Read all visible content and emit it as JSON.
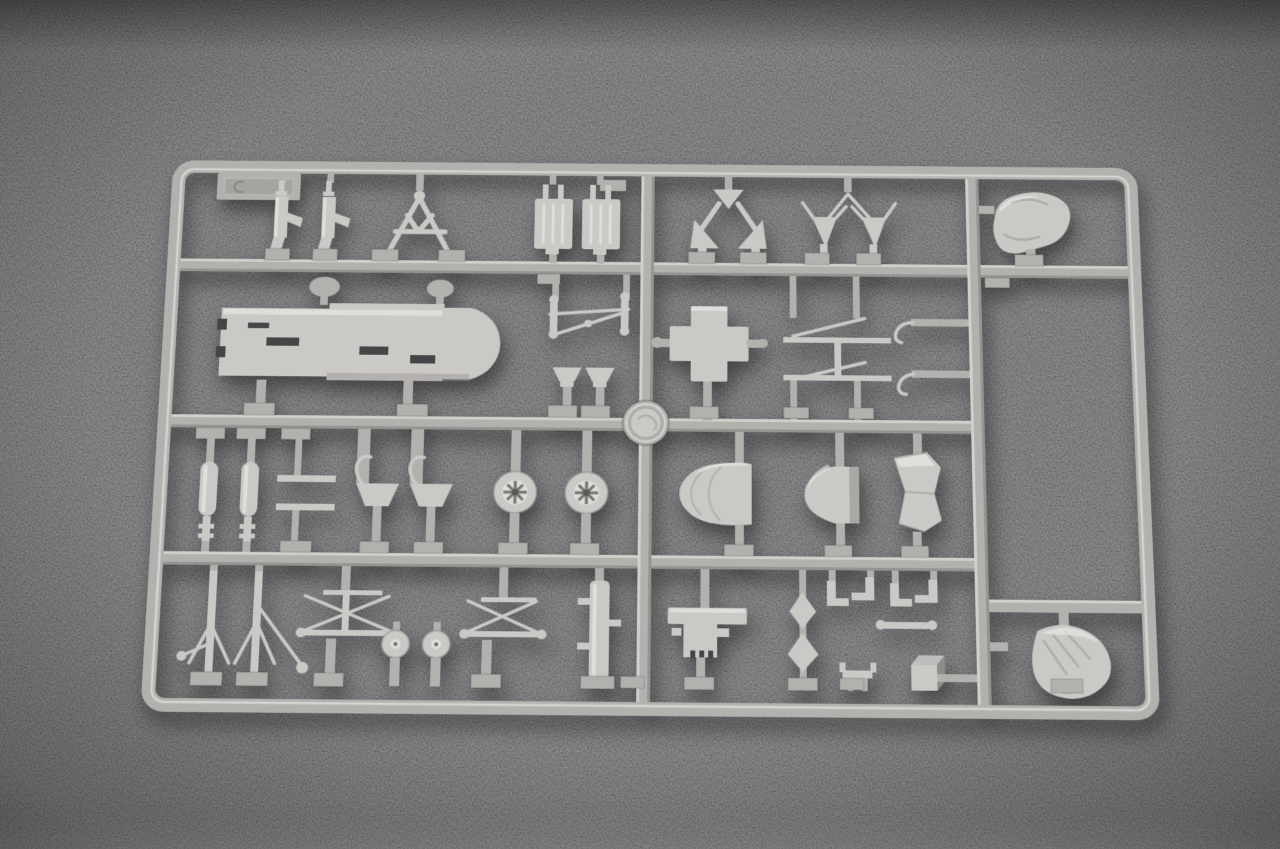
{
  "scene": {
    "type": "photograph",
    "subject": "Injection-moulded polystyrene model kit sprue (parts tree)",
    "setting": "Light grey plastic sprue lying flat on a dark grey carpet-like surface",
    "aria_label": "Grey plastic model-kit sprue full of unassembled aircraft parts, photographed on a dark grey textured carpet"
  },
  "colors": {
    "bg": "#57575a",
    "bg_light": "#6f6f71",
    "rail": "#b3b1ad",
    "rail_hi": "#e2e0dc",
    "rail_dk": "#87857f",
    "part": "#cbc9c5",
    "part_hi": "#edece9",
    "part_dk": "#8f8d89",
    "slot": "#454547"
  },
  "sprue": {
    "plastic": "light grey polystyrene",
    "frame": "rounded rectangular outer runner with three horizontal and two vertical internal runners",
    "mold_stamp": "circular embossed manufacturer medallion on the centre runner",
    "letter_tab": "blank rectangular identification tab at top left",
    "rows": [
      {
        "name": "row-1",
        "parts": [
          "machine gun",
          "machine gun",
          "A-frame support truss",
          "radiator block",
          "radiator block",
          "gun-mount yoke with gussets",
          "twin V-brackets",
          "pilot seat"
        ]
      },
      {
        "name": "row-2",
        "parts": [
          "fuselage floor panel",
          "control linkage assembly",
          "funnel scoop",
          "funnel scoop",
          "cross-shaped mount",
          "wing strut pair with hooks",
          "mould medallion"
        ]
      },
      {
        "name": "row-3",
        "parts": [
          "oleo strut",
          "oleo strut",
          "T-shaped lever",
          "T-shaped lever",
          "axle fork",
          "axle fork",
          "spoked wheel",
          "spoked wheel",
          "engine cowling dome",
          "cowling half",
          "faceted fairing"
        ]
      },
      {
        "name": "row-4",
        "parts": [
          "landing-gear tripod",
          "bracing truss",
          "disc wheel",
          "disc wheel",
          "bracing truss",
          "pivot bar with lugs",
          "gun receiver plate",
          "arrowhead bracket",
          "elbow fittings",
          "seat bracket",
          "ammunition box",
          "pilot seat"
        ]
      }
    ]
  }
}
